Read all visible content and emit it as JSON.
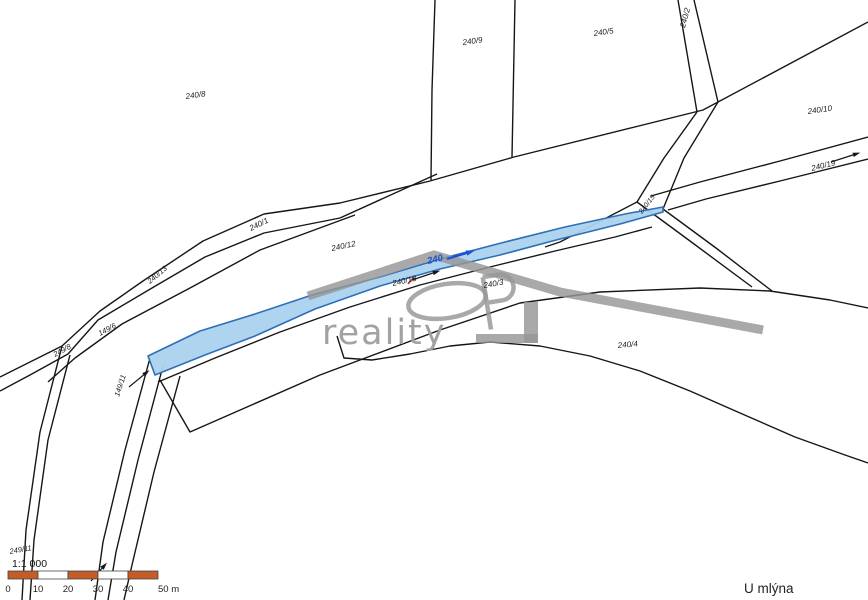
{
  "map": {
    "width": 868,
    "height": 600,
    "background": "#ffffff",
    "line_color": "#161616",
    "label_color": "#1c1c1c",
    "highlight": {
      "label": "240",
      "label_color": "#1d4fd7",
      "fill": "#abd2ef",
      "stroke": "#2f6fb4",
      "polygon": [
        [
          148,
          356
        ],
        [
          200,
          331
        ],
        [
          255,
          314
        ],
        [
          312,
          295
        ],
        [
          380,
          277
        ],
        [
          440,
          259
        ],
        [
          505,
          242
        ],
        [
          565,
          227
        ],
        [
          625,
          214
        ],
        [
          663,
          207
        ],
        [
          663,
          212
        ],
        [
          620,
          224
        ],
        [
          560,
          239
        ],
        [
          500,
          255
        ],
        [
          440,
          269
        ],
        [
          380,
          286
        ],
        [
          315,
          309
        ],
        [
          255,
          336
        ],
        [
          205,
          355
        ],
        [
          155,
          375
        ]
      ]
    },
    "labels": [
      {
        "text": "240/8",
        "x": 186,
        "y": 99,
        "rot": -8,
        "size": 8
      },
      {
        "text": "240/9",
        "x": 463,
        "y": 45,
        "rot": -8,
        "size": 8
      },
      {
        "text": "240/5",
        "x": 594,
        "y": 36,
        "rot": -8,
        "size": 8
      },
      {
        "text": "240/2",
        "x": 685,
        "y": 28,
        "rot": -75,
        "size": 8
      },
      {
        "text": "240/10",
        "x": 808,
        "y": 114,
        "rot": -8,
        "size": 8
      },
      {
        "text": "240/19",
        "x": 812,
        "y": 171,
        "rot": -14,
        "size": 8
      },
      {
        "text": "240/12",
        "x": 332,
        "y": 251,
        "rot": -12,
        "size": 8
      },
      {
        "text": "240/1",
        "x": 251,
        "y": 231,
        "rot": -26,
        "size": 8
      },
      {
        "text": "240/13",
        "x": 150,
        "y": 284,
        "rot": -40,
        "size": 7.5
      },
      {
        "text": "149/6",
        "x": 100,
        "y": 336,
        "rot": -28,
        "size": 7.5
      },
      {
        "text": "249/8",
        "x": 55,
        "y": 357,
        "rot": -28,
        "size": 7.5
      },
      {
        "text": "149/11",
        "x": 119,
        "y": 397,
        "rot": -72,
        "size": 7.5
      },
      {
        "text": "240/18",
        "x": 393,
        "y": 286,
        "rot": -13,
        "size": 8
      },
      {
        "text": "240/3",
        "x": 484,
        "y": 288,
        "rot": -10,
        "size": 8
      },
      {
        "text": "240/4",
        "x": 618,
        "y": 348,
        "rot": -5,
        "size": 8
      },
      {
        "text": "240/15",
        "x": 642,
        "y": 214,
        "rot": -52,
        "size": 7
      },
      {
        "text": "249/11",
        "x": 10,
        "y": 554,
        "rot": -10,
        "size": 7.5
      }
    ],
    "highlight_label": {
      "text": "240",
      "x": 428,
      "y": 264,
      "rot": -13,
      "size": 9.5
    },
    "arrows": [
      {
        "x1": 447,
        "y1": 259,
        "x2": 470,
        "y2": 252,
        "color": "#1d4fd7",
        "w": 2.2,
        "head": 6
      },
      {
        "x1": 412,
        "y1": 280,
        "x2": 436,
        "y2": 272,
        "color": "#161616",
        "w": 1.2,
        "head": 5
      },
      {
        "x1": 831,
        "y1": 162,
        "x2": 856,
        "y2": 154,
        "color": "#161616",
        "w": 1.2,
        "head": 5
      },
      {
        "x1": 129,
        "y1": 387,
        "x2": 146,
        "y2": 373,
        "color": "#161616",
        "w": 1.2,
        "head": 5
      },
      {
        "x1": 91,
        "y1": 581,
        "x2": 104,
        "y2": 566,
        "color": "#161616",
        "w": 1.2,
        "head": 5
      }
    ],
    "red_tick": {
      "x1": 408,
      "y1": 284,
      "x2": 414,
      "y2": 277,
      "color": "#c03028",
      "w": 1.5
    },
    "polylines": [
      {
        "pts": [
          [
            435,
            0
          ],
          [
            432,
            90
          ],
          [
            431,
            180
          ]
        ]
      },
      {
        "pts": [
          [
            515,
            0
          ],
          [
            512,
            157
          ]
        ]
      },
      {
        "pts": [
          [
            868,
            22
          ],
          [
            703,
            110
          ],
          [
            514,
            157
          ]
        ]
      },
      {
        "pts": [
          [
            678,
            0
          ],
          [
            697,
            112
          ]
        ]
      },
      {
        "pts": [
          [
            694,
            0
          ],
          [
            718,
            102
          ]
        ]
      },
      {
        "pts": [
          [
            697,
            112
          ],
          [
            664,
            158
          ],
          [
            637,
            202
          ],
          [
            560,
            242
          ],
          [
            545,
            247
          ]
        ]
      },
      {
        "pts": [
          [
            718,
            102
          ],
          [
            684,
            158
          ],
          [
            663,
            209
          ]
        ]
      },
      {
        "pts": [
          [
            637,
            202
          ],
          [
            690,
            241
          ],
          [
            752,
            287
          ]
        ]
      },
      {
        "pts": [
          [
            663,
            209
          ],
          [
            716,
            248
          ],
          [
            772,
            291
          ]
        ]
      },
      {
        "pts": [
          [
            868,
            137
          ],
          [
            780,
            161
          ],
          [
            700,
            182
          ],
          [
            651,
            196
          ]
        ]
      },
      {
        "pts": [
          [
            868,
            159
          ],
          [
            780,
            181
          ],
          [
            706,
            199
          ],
          [
            668,
            210
          ]
        ]
      },
      {
        "pts": [
          [
            514,
            157
          ],
          [
            430,
            181
          ],
          [
            340,
            203
          ],
          [
            264,
            214
          ],
          [
            203,
            241
          ],
          [
            143,
            281
          ],
          [
            100,
            311
          ],
          [
            62,
            346
          ],
          [
            0,
            377
          ]
        ]
      },
      {
        "pts": [
          [
            437,
            174
          ],
          [
            340,
            218
          ],
          [
            264,
            233
          ],
          [
            205,
            257
          ],
          [
            152,
            288
          ],
          [
            98,
            320
          ],
          [
            68,
            354
          ],
          [
            30,
            375
          ],
          [
            0,
            391
          ]
        ]
      },
      {
        "pts": [
          [
            355,
            215
          ],
          [
            260,
            250
          ],
          [
            190,
            288
          ],
          [
            122,
            324
          ],
          [
            75,
            358
          ],
          [
            48,
            382
          ]
        ]
      },
      {
        "pts": [
          [
            62,
            346
          ],
          [
            40,
            432
          ],
          [
            26,
            530
          ],
          [
            22,
            600
          ]
        ]
      },
      {
        "pts": [
          [
            70,
            355
          ],
          [
            48,
            440
          ],
          [
            34,
            540
          ],
          [
            30,
            600
          ]
        ]
      },
      {
        "pts": [
          [
            150,
            358
          ],
          [
            125,
            450
          ],
          [
            103,
            542
          ],
          [
            95,
            600
          ]
        ]
      },
      {
        "pts": [
          [
            163,
            366
          ],
          [
            138,
            460
          ],
          [
            116,
            552
          ],
          [
            108,
            600
          ]
        ]
      },
      {
        "pts": [
          [
            180,
            376
          ],
          [
            154,
            472
          ],
          [
            132,
            565
          ],
          [
            124,
            600
          ]
        ]
      },
      {
        "pts": [
          [
            158,
            382
          ],
          [
            215,
            358
          ],
          [
            280,
            332
          ],
          [
            350,
            307
          ],
          [
            420,
            285
          ],
          [
            490,
            267
          ],
          [
            555,
            251
          ],
          [
            615,
            237
          ],
          [
            652,
            227
          ]
        ]
      },
      {
        "pts": [
          [
            160,
            380
          ],
          [
            190,
            432
          ],
          [
            320,
            375
          ],
          [
            440,
            330
          ],
          [
            520,
            303
          ],
          [
            600,
            292
          ],
          [
            700,
            288
          ],
          [
            770,
            291
          ],
          [
            830,
            300
          ],
          [
            868,
            308
          ]
        ]
      },
      {
        "pts": [
          [
            337,
            336
          ],
          [
            344,
            358
          ],
          [
            372,
            360
          ],
          [
            410,
            354
          ],
          [
            450,
            346
          ],
          [
            490,
            342
          ],
          [
            540,
            346
          ],
          [
            590,
            356
          ],
          [
            640,
            371
          ],
          [
            690,
            391
          ],
          [
            740,
            413
          ],
          [
            795,
            437
          ],
          [
            845,
            455
          ],
          [
            868,
            463
          ]
        ]
      }
    ],
    "watermark": {
      "text": "reality",
      "text_color": "#a2a2a2",
      "text_x": 322,
      "text_y": 344,
      "text_size": 35,
      "logo_color": "rgba(150,150,150,0.82)",
      "roof": [
        [
          308,
          296
        ],
        [
          434,
          255
        ],
        [
          560,
          292
        ],
        [
          763,
          330
        ]
      ],
      "ellipse": {
        "cx": 447,
        "cy": 301,
        "rx": 39,
        "ry": 17,
        "rot": -9
      },
      "bracket_v": {
        "x": 524,
        "y": 302,
        "w": 14,
        "h": 41
      },
      "bracket_h": {
        "x": 476,
        "y": 334,
        "w": 62,
        "h": 9
      }
    },
    "scalebar": {
      "ratio_label": "1:1 000",
      "ratio_x": 12,
      "ratio_y": 567,
      "x": 8,
      "y": 571,
      "seg_w": 30,
      "seg_h": 8,
      "segments": 5,
      "bar_color": "#c45c28",
      "alt_color": "#ffffff",
      "border_color": "#444444",
      "ticks": [
        "0",
        "10",
        "20",
        "30",
        "40",
        "50 m"
      ],
      "tick_y": 592
    },
    "area_label": {
      "text": "U mlýna",
      "x": 744,
      "y": 593,
      "size": 13.5,
      "color": "#222222"
    }
  }
}
